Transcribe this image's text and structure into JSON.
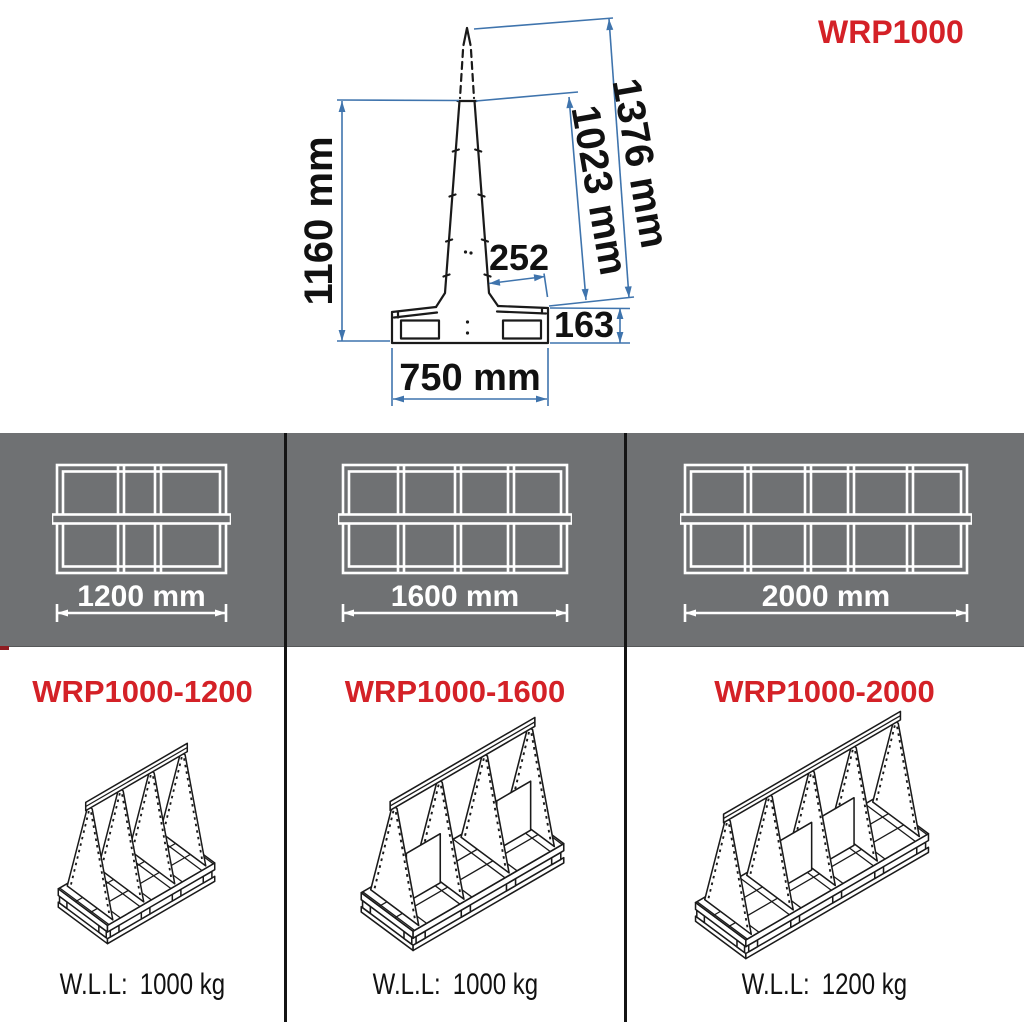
{
  "title": "WRP1000",
  "side_view": {
    "dim_total_height": "1376 mm",
    "dim_frame_height": "1023 mm",
    "dim_upright_height": "1160 mm",
    "dim_top_width": "252",
    "dim_base_height": "163",
    "dim_base_width": "750 mm"
  },
  "top_views": [
    {
      "width_label": "1200 mm"
    },
    {
      "width_label": "1600 mm"
    },
    {
      "width_label": "2000 mm"
    }
  ],
  "products": [
    {
      "model": "WRP1000-1200",
      "wll_label": "W.L.L:",
      "wll_value": "1000 kg"
    },
    {
      "model": "WRP1000-1600",
      "wll_label": "W.L.L:",
      "wll_value": "1000 kg"
    },
    {
      "model": "WRP1000-2000",
      "wll_label": "W.L.L:",
      "wll_value": "1200 kg"
    }
  ],
  "colors": {
    "accent_red": "#d42127",
    "dimension_blue": "#3f74ad",
    "band_gray": "#6f7173",
    "line_black": "#1a1a1a"
  }
}
